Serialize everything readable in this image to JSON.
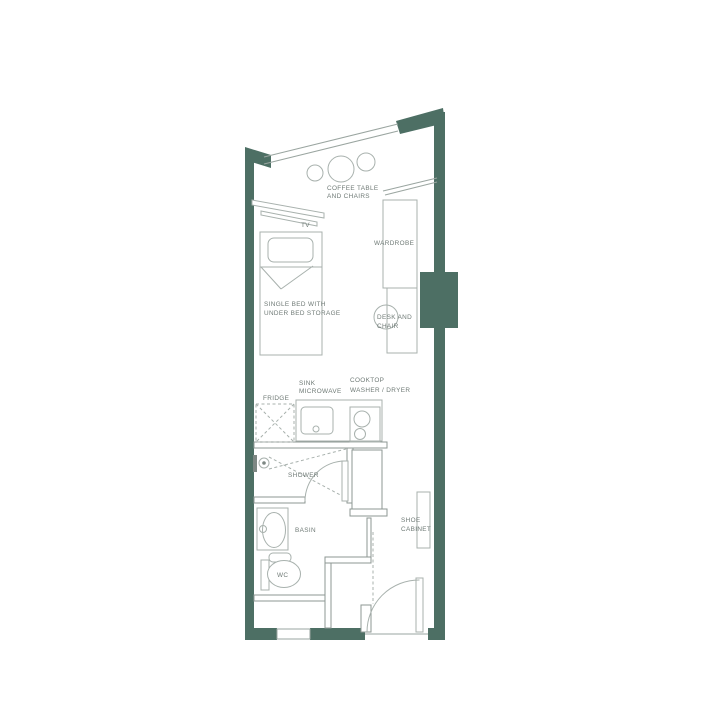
{
  "page": {
    "type": "studio-apartment-floor-plan"
  },
  "colors": {
    "wall": "#4d6f64",
    "furniture_line": "#a8b1ad",
    "partition_line": "#8d9793",
    "text": "#6f7a76",
    "background": "#ffffff"
  },
  "labels": {
    "coffee_table_line1": "COFFEE TABLE",
    "coffee_table_line2": "AND CHAIRS",
    "tv": "TV",
    "wardrobe": "WARDROBE",
    "bed_line1": "SINGLE BED WITH",
    "bed_line2": "UNDER BED STORAGE",
    "desk_line1": "DESK AND",
    "desk_line2": "CHAIR",
    "sink_line1": "SINK",
    "sink_line2": "MICROWAVE",
    "cooktop_line1": "COOKTOP",
    "cooktop_line2": "WASHER / DRYER",
    "fridge": "FRIDGE",
    "shower": "SHOWER",
    "basin": "BASIN",
    "wc": "WC",
    "shoe_cabinet_line1": "SHOE",
    "shoe_cabinet_line2": "CABINET"
  }
}
